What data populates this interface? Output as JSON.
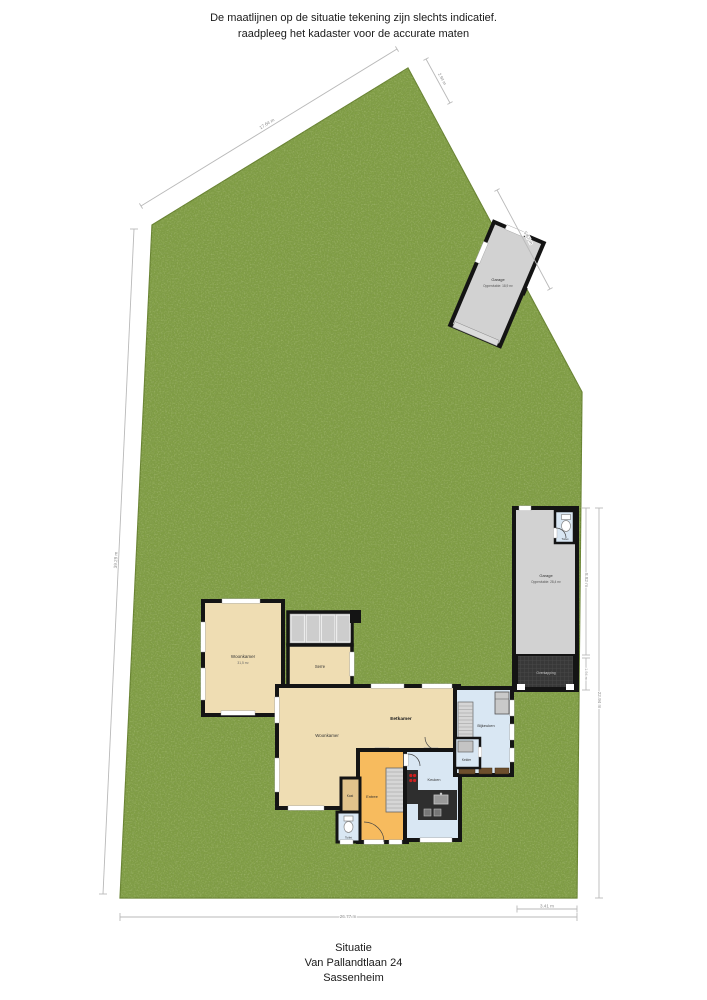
{
  "header": {
    "line1": "De maatlijnen op de situatie tekening zijn slechts indicatief.",
    "line2": "raadpleeg het kadaster voor de accurate maten"
  },
  "footer": {
    "line1": "Situatie",
    "line2": "Van Pallandtlaan 24",
    "line3": "Sassenheim"
  },
  "colors": {
    "grass": "#7e9c42",
    "room_tan": "#efddb3",
    "room_orange": "#f7bb5e",
    "room_blue": "#d9e7f3",
    "garage_gray": "#d2d2d2",
    "wall": "#141414"
  },
  "rooms": {
    "woonkamer_1": {
      "label": "Woonkamer",
      "sublabel": "31,5 m²"
    },
    "serre": {
      "label": "Serre"
    },
    "eetkamer": {
      "label": "Eetkamer"
    },
    "woonkamer_2": {
      "label": "Woonkamer"
    },
    "entree": {
      "label": "Entree"
    },
    "kast": {
      "label": "Kast"
    },
    "toilet": {
      "label": "Toilet"
    },
    "keuken": {
      "label": "Keuken"
    },
    "kelder": {
      "label": "Kelder"
    },
    "bijkeuken": {
      "label": "Bijkeuken"
    }
  },
  "garage_top": {
    "label": "Garage",
    "sublabel": "Oppervlakte: 18,9 m²"
  },
  "garage_right": {
    "label": "Garage",
    "sublabel": "Oppervlakte: 28,4 m²",
    "toilet_label": "Toilet",
    "canopy_label": "Overkapping"
  },
  "dimensions": {
    "left": "39.29 m",
    "top_left": "17.64 m",
    "apex": "2.94 m",
    "garage_edge": "5.67 m",
    "garage_right_height": "8.82 m",
    "canopy_height": "1.94 m",
    "right_total": "22.94 m",
    "bottom_total": "26.77 m",
    "bottom_right": "3.41 m"
  }
}
